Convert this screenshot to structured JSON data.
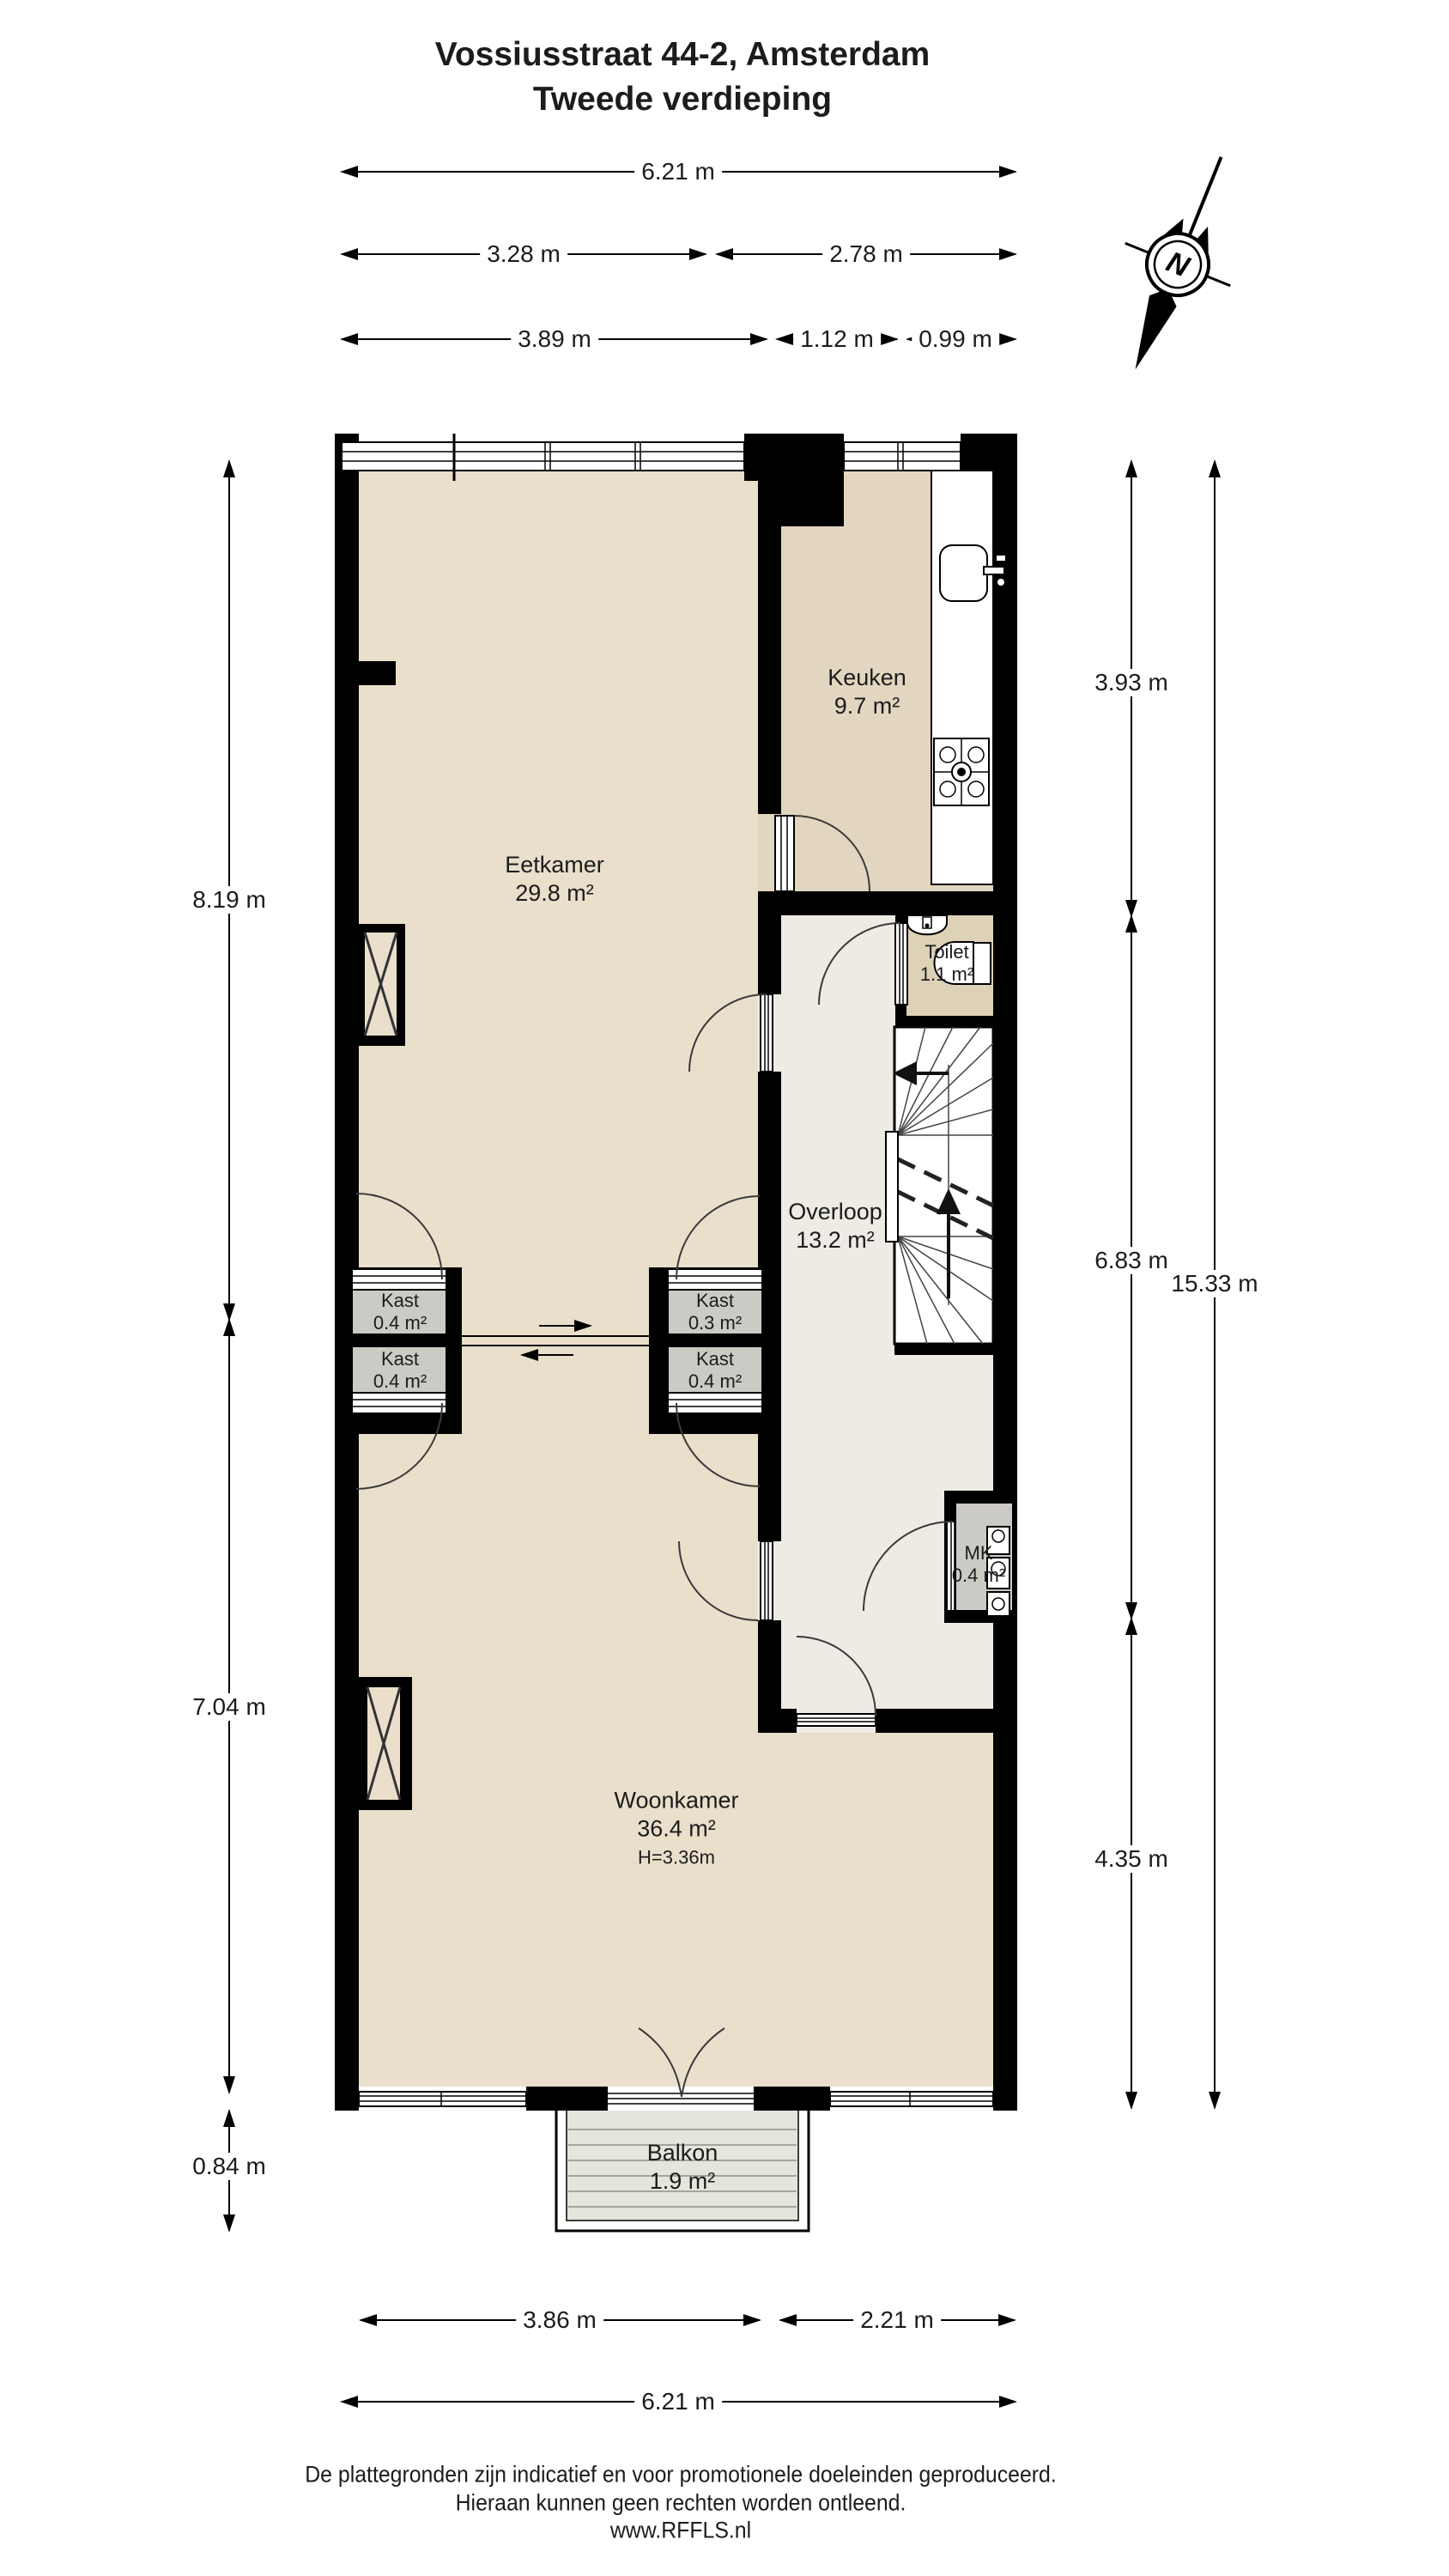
{
  "title": {
    "line1": "Vossiusstraat 44-2, Amsterdam",
    "line2": "Tweede verdieping"
  },
  "compass": {
    "north_label": "N"
  },
  "rooms": {
    "eetkamer": {
      "name": "Eetkamer",
      "area": "29.8 m²"
    },
    "keuken": {
      "name": "Keuken",
      "area": "9.7 m²"
    },
    "toilet": {
      "name": "Toilet",
      "area": "1.1 m²"
    },
    "overloop": {
      "name": "Overloop",
      "area": "13.2 m²"
    },
    "kast_left_top": {
      "name": "Kast",
      "area": "0.4 m²"
    },
    "kast_left_bottom": {
      "name": "Kast",
      "area": "0.4 m²"
    },
    "kast_mid_top": {
      "name": "Kast",
      "area": "0.3 m²"
    },
    "kast_mid_bottom": {
      "name": "Kast",
      "area": "0.4 m²"
    },
    "mk": {
      "name": "MK",
      "area": "0.4 m²"
    },
    "woonkamer": {
      "name": "Woonkamer",
      "area": "36.4 m²",
      "ceiling_height": "H=3.36m"
    },
    "balkon": {
      "name": "Balkon",
      "area": "1.9 m²"
    }
  },
  "dimensions": {
    "top_total": "6.21 m",
    "top_left": "3.28 m",
    "top_right": "2.78 m",
    "top_sub_left": "3.89 m",
    "top_sub_mid": "1.12 m",
    "top_sub_right": "0.99 m",
    "left_upper": "8.19 m",
    "left_lower": "7.04 m",
    "left_balkon": "0.84 m",
    "right_keuken": "3.93 m",
    "right_mid": "6.83 m",
    "right_lower": "4.35 m",
    "right_total": "15.33 m",
    "bottom_left": "3.86 m",
    "bottom_right": "2.21 m",
    "bottom_total": "6.21 m"
  },
  "footer": {
    "line1": "De plattegronden zijn indicatief en voor promotionele doeleinden geproduceerd.",
    "line2": "Hieraan kunnen geen rechten worden ontleend.",
    "line3": "www.RFFLS.nl"
  },
  "colors": {
    "wall": "#000000",
    "floor": "#e9dfcb",
    "keuken_floor": "#e2d6c0",
    "toilet_floor": "#ddd1b8",
    "overloop_floor": "#edebe3",
    "closet_fill": "#cccac4",
    "balkon_floor": "#e5e5dc"
  }
}
